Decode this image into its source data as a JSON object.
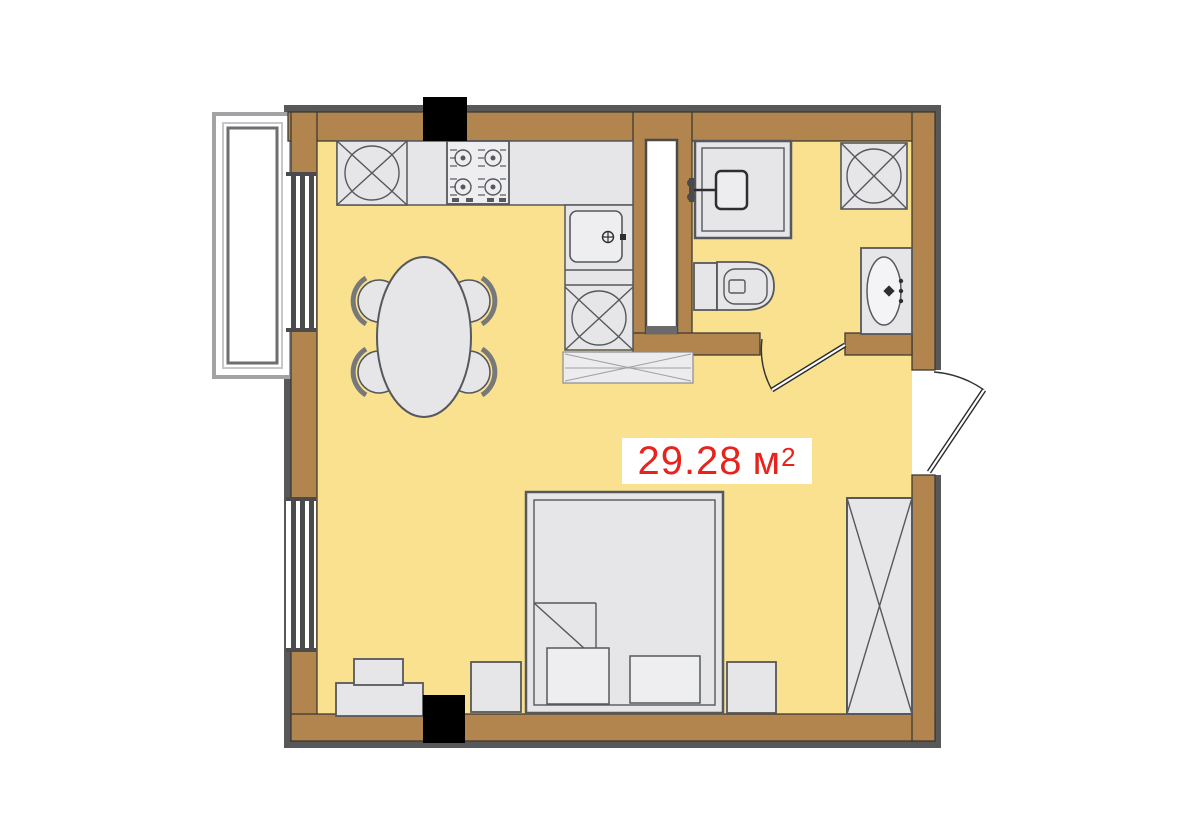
{
  "meta": {
    "width": 1200,
    "height": 834,
    "kind": "apartment-floor-plan"
  },
  "area_label": {
    "value": "29.28",
    "unit": "м",
    "superscript": "2"
  },
  "colors": {
    "floor": "#f9e190",
    "wall": "#b2854e",
    "outline": "#58585a",
    "fixture": "#e6e6e8",
    "fixture_stroke": "#55585c",
    "column": "#000000",
    "glass": "#ffffff",
    "accent": "#e8231d",
    "label_bg": "#ffffff"
  },
  "symbols": [
    "balcony-window-bay",
    "window",
    "refrigerator",
    "stove",
    "kitchen-counter",
    "kitchen-sink",
    "dishwasher",
    "counter-hatch",
    "dining-table",
    "chair",
    "ventilation-shaft",
    "shower",
    "washing-machine",
    "toilet",
    "vanity-sink",
    "bathroom-door",
    "entrance-door",
    "bed",
    "pillow",
    "nightstand",
    "wardrobe",
    "dresser",
    "structural-column"
  ]
}
